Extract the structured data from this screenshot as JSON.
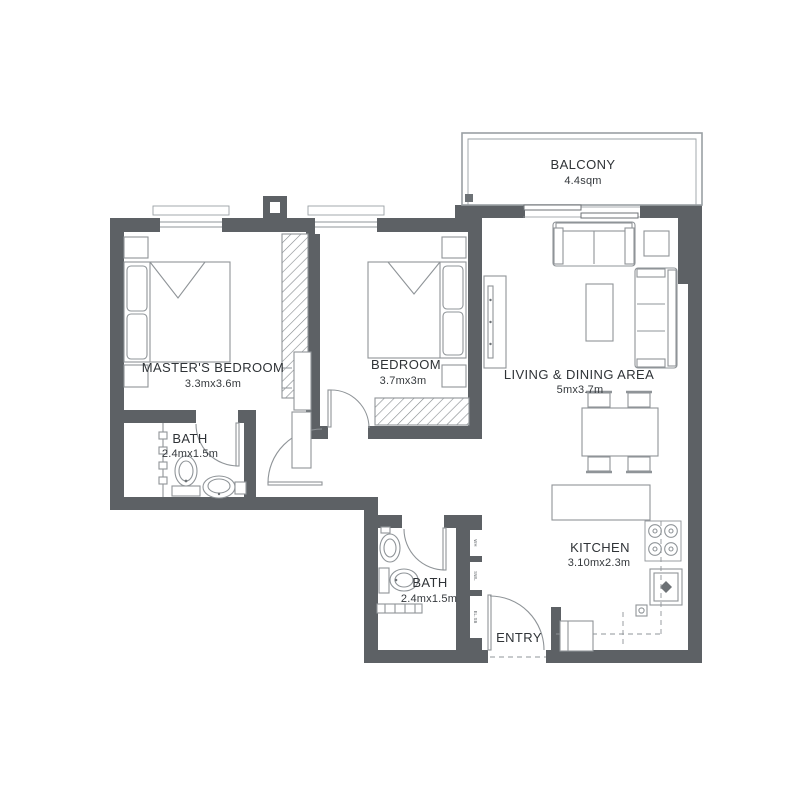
{
  "rooms": {
    "balcony": {
      "name": "BALCONY",
      "size": "4.4sqm"
    },
    "master_bedroom": {
      "name": "MASTER'S BEDROOM",
      "size": "3.3mx3.6m"
    },
    "bedroom": {
      "name": "BEDROOM",
      "size": "3.7mx3m"
    },
    "living_dining": {
      "name": "LIVING & DINING AREA",
      "size": "5mx3.7m"
    },
    "bath_1": {
      "name": "BATH",
      "size": "2.4mx1.5m"
    },
    "bath_2": {
      "name": "BATH",
      "size": "2.4mx1.5m"
    },
    "kitchen": {
      "name": "KITCHEN",
      "size": "3.10mx2.3m"
    },
    "entry": {
      "name": "ENTRY"
    }
  },
  "utility_labels": [
    "WH",
    "SWL",
    "EL.SB"
  ],
  "colors": {
    "wall": "#5d6165",
    "furniture_line": "#8f9498",
    "text": "#2f3337"
  }
}
